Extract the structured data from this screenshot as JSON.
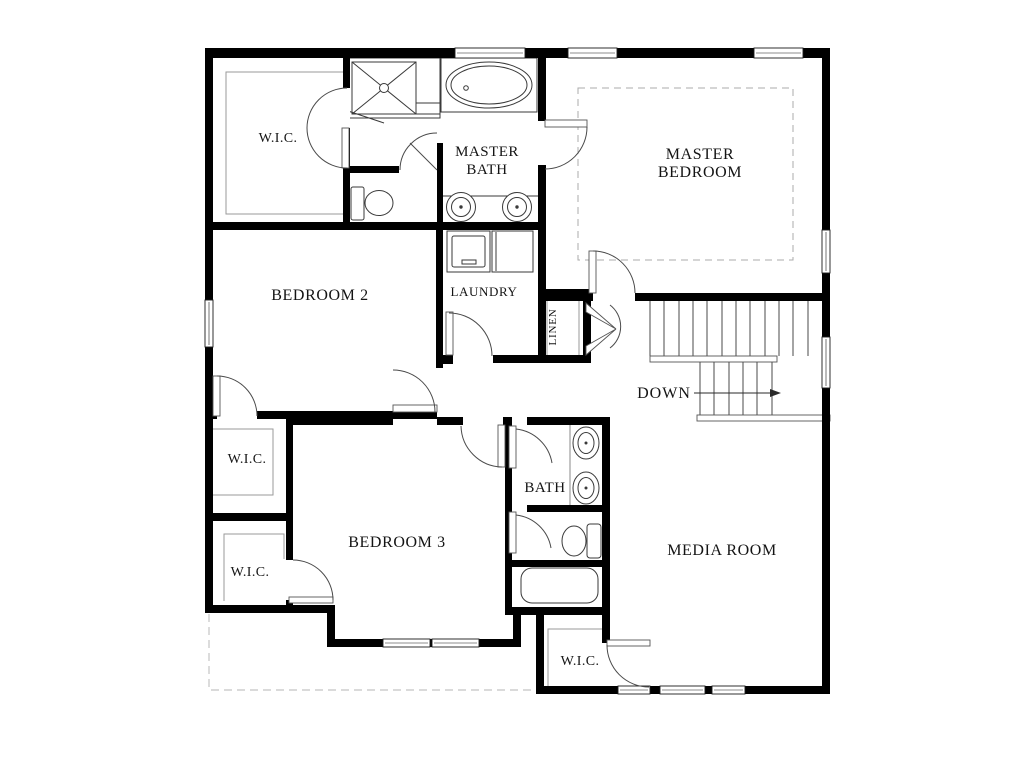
{
  "colors": {
    "wall": "#000000",
    "thin_line": "#3a3a3a",
    "shelf_outline": "#9a9a9a",
    "dashed_line": "#c4c4c4",
    "background": "#ffffff",
    "text": "#141414"
  },
  "labels": {
    "wic_master": "W.I.C.",
    "master_bath_line1": "MASTER",
    "master_bath_line2": "BATH",
    "master_bedroom_line1": "MASTER",
    "master_bedroom_line2": "BEDROOM",
    "bedroom_2": "BEDROOM 2",
    "laundry": "LAUNDRY",
    "linen": "LINEN",
    "stairs_down": "DOWN",
    "wic_bedroom2": "W.I.C.",
    "bedroom_3": "BEDROOM 3",
    "bath": "BATH",
    "media_room": "MEDIA ROOM",
    "wic_bedroom3": "W.I.C.",
    "wic_media": "W.I.C."
  },
  "fixtures": {
    "master_bath": [
      "shower",
      "bathtub",
      "toilet",
      "double-sink-vanity"
    ],
    "laundry_room": [
      "washer",
      "dryer"
    ],
    "hall_bath": [
      "double-sink-vanity",
      "toilet",
      "bathtub"
    ],
    "stairwell": [
      "staircase",
      "down-arrow"
    ]
  }
}
